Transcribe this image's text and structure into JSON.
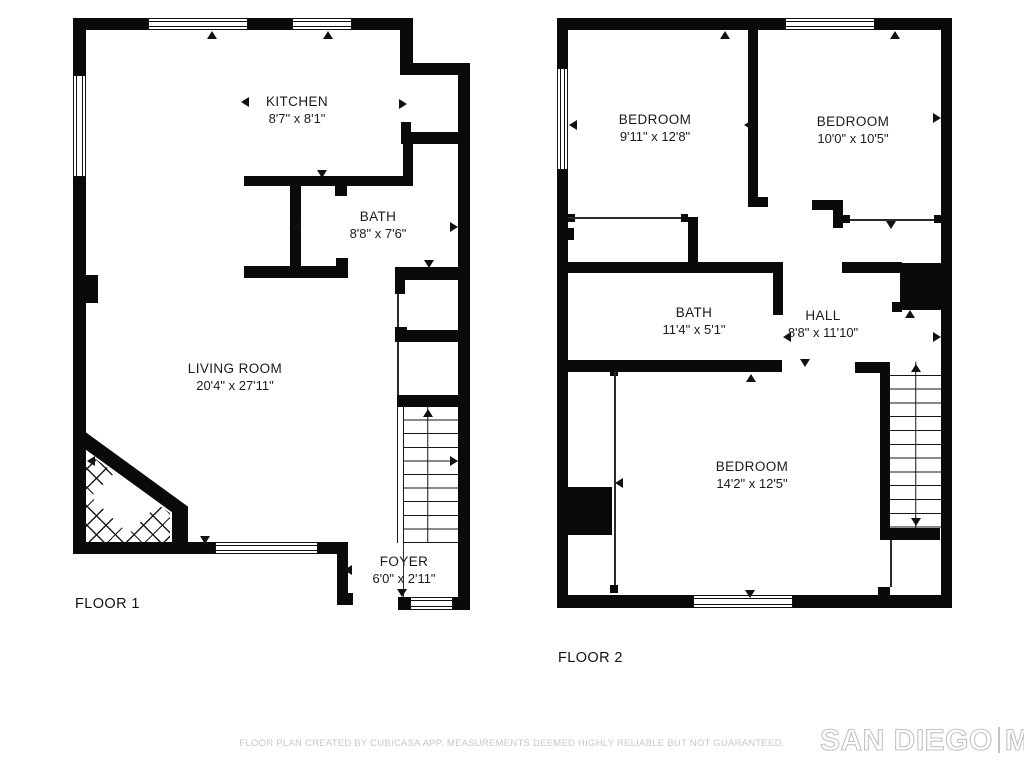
{
  "floors": [
    {
      "title": "FLOOR 1",
      "rooms": [
        {
          "name": "KITCHEN",
          "dims": "8'7\" x 8'1\""
        },
        {
          "name": "BATH",
          "dims": "8'8\" x 7'6\""
        },
        {
          "name": "LIVING ROOM",
          "dims": "20'4\" x 27'11\""
        },
        {
          "name": "FOYER",
          "dims": "6'0\" x 2'11\""
        }
      ]
    },
    {
      "title": "FLOOR 2",
      "rooms": [
        {
          "name": "BEDROOM",
          "dims": "9'11\" x 12'8\""
        },
        {
          "name": "BEDROOM",
          "dims": "10'0\" x 10'5\""
        },
        {
          "name": "BATH",
          "dims": "11'4\" x 5'1\""
        },
        {
          "name": "HALL",
          "dims": "8'8\" x 11'10\""
        },
        {
          "name": "BEDROOM",
          "dims": "14'2\" x 12'5\""
        }
      ]
    }
  ],
  "footer": {
    "disclaimer": "FLOOR PLAN CREATED BY CUBICASA APP. MEASUREMENTS DEEMED HIGHLY RELIABLE BUT NOT GUARANTEED.",
    "logo_left": "SAN DIEGO",
    "logo_right": "MLS"
  }
}
